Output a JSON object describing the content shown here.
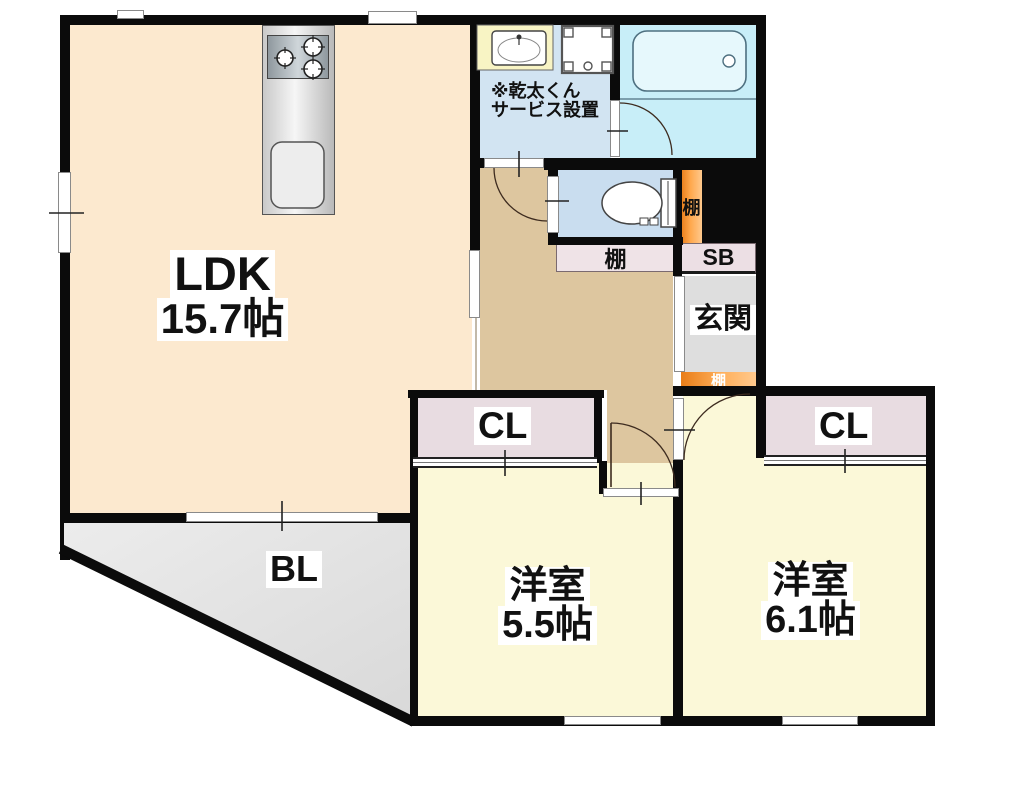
{
  "floorplan": {
    "rooms": {
      "ldk": {
        "label": "LDK",
        "size": "15.7帖"
      },
      "bedroom_a": {
        "label": "洋室",
        "size": "5.5帖"
      },
      "bedroom_b": {
        "label": "洋室",
        "size": "6.1帖"
      },
      "closet_a": {
        "label": "CL"
      },
      "closet_b": {
        "label": "CL"
      },
      "balcony": {
        "label": "BL"
      },
      "entrance": {
        "label": "玄関"
      },
      "shoe_box": {
        "label": "SB"
      },
      "shelf_wc": {
        "label": "棚"
      },
      "shelf_hall": {
        "label": "棚"
      },
      "shelf_entrance": {
        "label": "棚"
      }
    },
    "notes": {
      "dryer_line1": "※乾太くん",
      "dryer_line2": "サービス設置"
    },
    "colors": {
      "ldk_floor": "#fce9cf",
      "hall_floor": "#ddc69f",
      "bedroom_floor": "#fbf8d8",
      "closet": "#e8dce1",
      "entrance_floor": "#dedede",
      "balcony": "#e3e3e3",
      "washroom": "#d2e4f2",
      "toilet_room": "#c9ddef",
      "bathroom": "#c8eef8",
      "counter_yellow": "#f8f4c4",
      "shelf_orange": "#f08a28",
      "shelf_strip": "#efe3e7",
      "wall": "#0b0b0b"
    }
  }
}
